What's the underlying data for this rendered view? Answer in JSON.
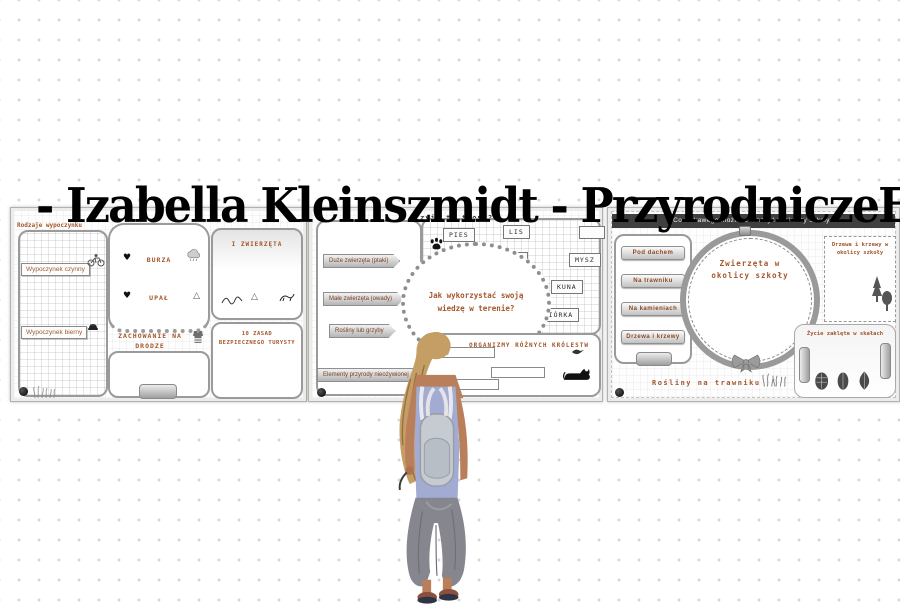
{
  "overlay": {
    "title": "- Izabella Kleinszmidt - PrzyrodniczeEcho"
  },
  "icons": {
    "heart": "♥",
    "triangle": "△",
    "tent": "△"
  },
  "colors": {
    "accent_brown": "#a3552a",
    "overlay_text": "#000000",
    "dot": "#d8d5d2"
  },
  "slides": [
    {
      "id": "bezpieczenstwo",
      "corner_label": "Rodzaje wypoczynku",
      "rest_types": [
        "Wypoczynek czynny",
        "Wypoczynek bierny"
      ],
      "weather_hazards": [
        "BURZA",
        "UPAŁ"
      ],
      "road_heading": "ZACHOWANIE NA DRODZE",
      "animals_heading": "I ZWIERZĘTA",
      "tourist_rules_heading": "10 ZASAD BEZPIECZNEGO TURYSTY"
    },
    {
      "id": "tropy",
      "title": "Czyje to tropy?",
      "observation_labels": [
        "Duże zwierzęta (ptaki)",
        "Małe zwierzęta (owady)",
        "Rośliny lub grzyby",
        "Elementy przyrody nieożywionej"
      ],
      "question": "Jak wykorzystać swoją wiedzę w terenie?",
      "track_labels": [
        "PIES",
        "LIS",
        "",
        "KOT",
        "MYSZ",
        "ZAJĄC",
        "KUNA",
        "WIEWIÓRKA"
      ],
      "kingdoms_heading": "ORGANIZMY RÓŻNYCH KRÓLESTW"
    },
    {
      "id": "okolica-szkoly",
      "title": "Co ciekawego można zobaczyć w okolicy szkoły?",
      "place_buttons": [
        "Pod dachem",
        "Na trawniku",
        "Na kamieniach",
        "Drzewa i krzewy"
      ],
      "hoop_label": "Zwierzęta w okolicy szkoły",
      "trees_label": "Drzewa i krzewy w okolicy szkoły",
      "rocks_label": "Życie zaklęte w skałach",
      "bottom_label": "Rośliny na trawniku"
    }
  ]
}
